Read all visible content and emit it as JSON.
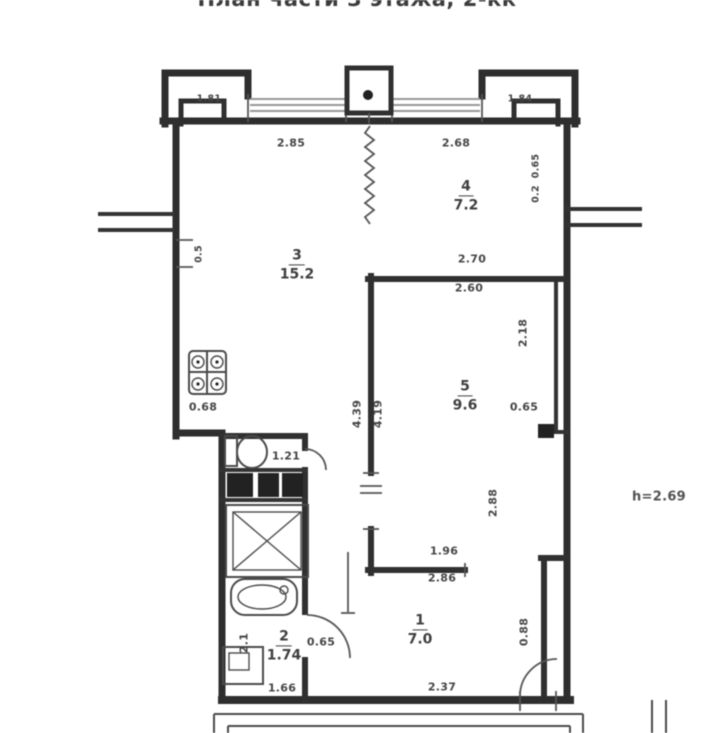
{
  "title": "План части 3 этажа, 2-кк",
  "height_note": "h=2.69",
  "rooms": [
    {
      "num": "1",
      "area": "7.0"
    },
    {
      "num": "2",
      "area": "1.74"
    },
    {
      "num": "3",
      "area": "15.2"
    },
    {
      "num": "4",
      "area": "7.2"
    },
    {
      "num": "5",
      "area": "9.6"
    }
  ],
  "dims": [
    "2.85",
    "2.68",
    "1.81",
    "1.84",
    "0.65",
    "0.2",
    "0.5",
    "2.70",
    "2.60",
    "2.18",
    "0.68",
    "0.65",
    "4.39",
    "4.19",
    "1.21",
    "2.88",
    "1.96",
    "2.86",
    "2.1",
    "0.65",
    "1.66",
    "2.37",
    "0.88"
  ],
  "fixtures": [
    "stove-icon",
    "toilet-icon",
    "shower-icon",
    "sink-icon",
    "washer-icon",
    "column-dot"
  ],
  "colors": {
    "wall": "#2e2e2e",
    "line": "#555555",
    "window": "#979797",
    "label": "#454545",
    "background": "#ffffff"
  }
}
